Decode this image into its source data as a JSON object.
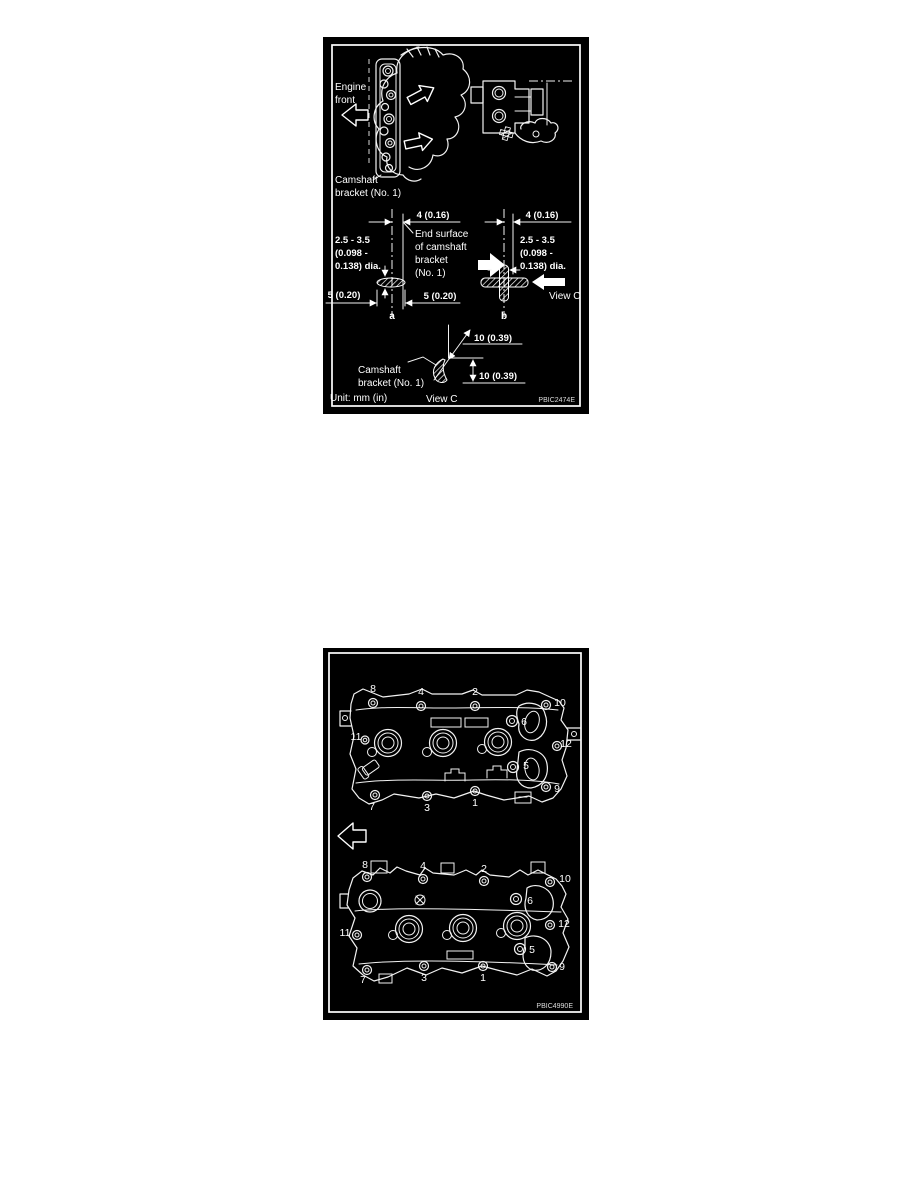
{
  "colors": {
    "page_background": "#ffffff",
    "figure_background": "#000000",
    "line_color": "#ffffff"
  },
  "figure1": {
    "code": "PBIC2474E",
    "engine_front": [
      "Engine",
      "front"
    ],
    "camshaft_bracket_label": [
      "Camshaft",
      "bracket (No. 1)"
    ],
    "end_surface_label": [
      "End surface",
      "of camshaft",
      "bracket",
      "(No. 1)"
    ],
    "dim_top": "4 (0.16)",
    "dim_dia": [
      "2.5 - 3.5",
      "(0.098 -",
      "0.138) dia."
    ],
    "dim_side": "5 (0.20)",
    "dim_corner": "10 (0.39)",
    "label_a": "a",
    "label_b": "b",
    "view_c": "View C",
    "unit": "Unit: mm (in)"
  },
  "figure2": {
    "code": "PBIC4990E",
    "bolt_numbers": [
      "1",
      "2",
      "3",
      "4",
      "5",
      "6",
      "7",
      "8",
      "9",
      "10",
      "11",
      "12"
    ]
  }
}
